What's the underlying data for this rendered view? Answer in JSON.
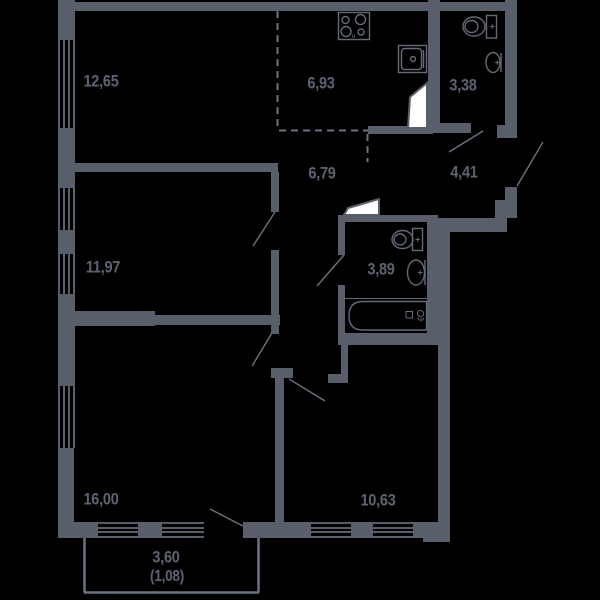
{
  "colors": {
    "background": "#000000",
    "wall": "#595e6b",
    "thin_line": "#6b7282",
    "door_leaf_fill": "#ffffff",
    "label": "#5d6370"
  },
  "rooms": [
    {
      "name": "room-top-left",
      "area": "12,65"
    },
    {
      "name": "kitchen",
      "area": "6,93"
    },
    {
      "name": "bathroom-small",
      "area": "3,38"
    },
    {
      "name": "hallway",
      "area": "6,79"
    },
    {
      "name": "entry-corridor",
      "area": "4,41"
    },
    {
      "name": "room-middle-left",
      "area": "11,97"
    },
    {
      "name": "bathroom-large",
      "area": "3,89"
    },
    {
      "name": "room-bottom-left",
      "area": "16,00"
    },
    {
      "name": "room-bottom-right",
      "area": "10,63"
    },
    {
      "name": "balcony",
      "area": "3,60",
      "area_reduced": "(1,08)"
    }
  ],
  "fixtures": {
    "stove_mark": "н",
    "list": [
      "stove-icon",
      "kitchen-sink-icon",
      "toilet-icon",
      "washbasin-icon",
      "toilet-icon",
      "washbasin-icon",
      "bathtub-icon"
    ]
  }
}
